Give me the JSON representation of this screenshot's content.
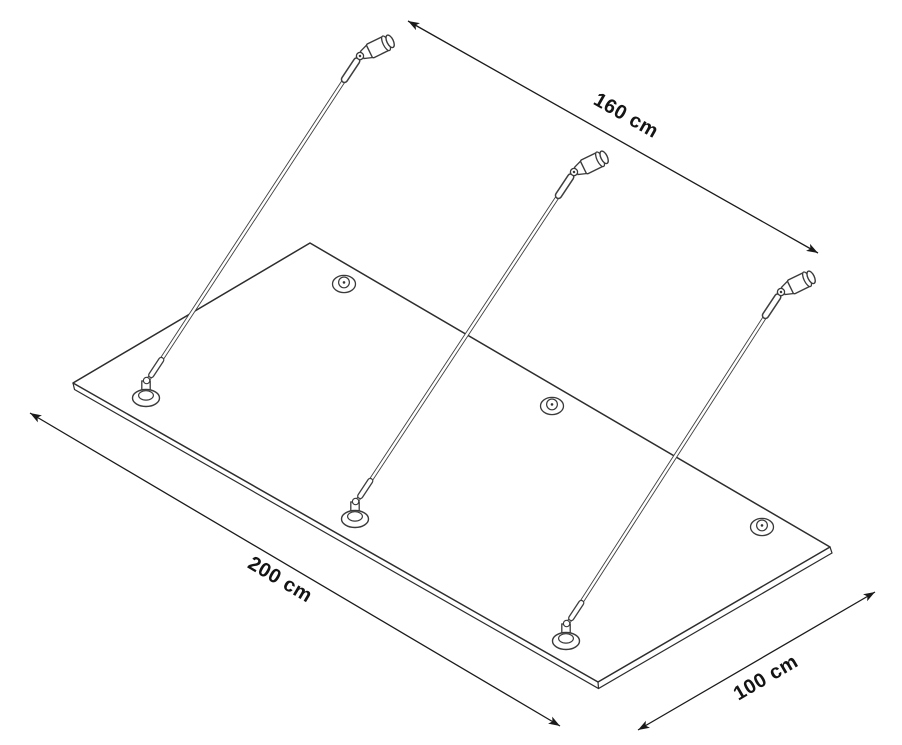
{
  "diagram": {
    "title": "Glass canopy technical drawing",
    "view": "isometric line drawing",
    "background_color": "#ffffff",
    "line_color": "#2d2d2d",
    "dimension_color": "#1a1a1a",
    "dimensions": {
      "width_label": "160 cm",
      "length_label": "200 cm",
      "depth_label": "100 cm"
    },
    "counts": {
      "support_rods": 3,
      "wall_anchors": 3,
      "rod_glass_mounts": 3,
      "point_fixing_caps": 3
    }
  }
}
